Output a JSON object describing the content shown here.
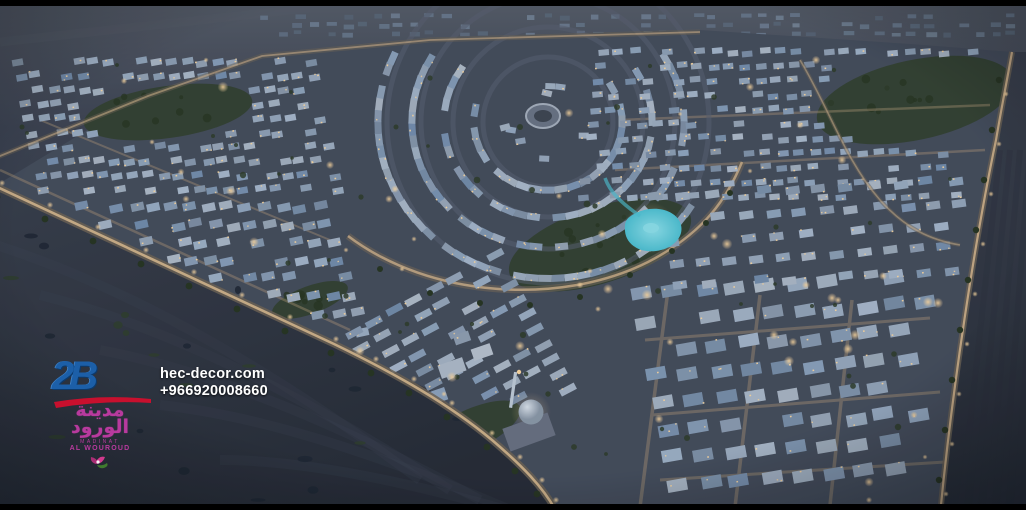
{
  "scene": {
    "type": "aerial-dusk-render",
    "subject_visible_brand": "AL WOUROUD residential master plan, night aerial view",
    "colors": {
      "sky_top": "#565b66",
      "desert_dark": "#262a34",
      "desert_mid": "#383d49",
      "desert_right": "#333845",
      "city_base": "#454c5a",
      "window_warm": "#ffd9a0",
      "road_glow": "#dcba8e",
      "road_under": "#6e6354",
      "park_green": "#33402c",
      "tree_green": "#27331f",
      "water": "#4fc3d4",
      "water_light": "#8fe2ec",
      "dome_light": "#dde4ec",
      "vignette": "rgba(5,8,15,0.45)"
    }
  },
  "watermark": {
    "agency_logo": "2B",
    "website": "hec-decor.com",
    "phone": "+966920008660",
    "logo_blue": "#1c5fa8",
    "logo_red": "#c8102e",
    "brand_arabic": "مدينة الورود",
    "brand_latin_line1": "MADINAT",
    "brand_latin_line2": "AL WOUROUD",
    "brand_pink": "#b83a9e"
  }
}
